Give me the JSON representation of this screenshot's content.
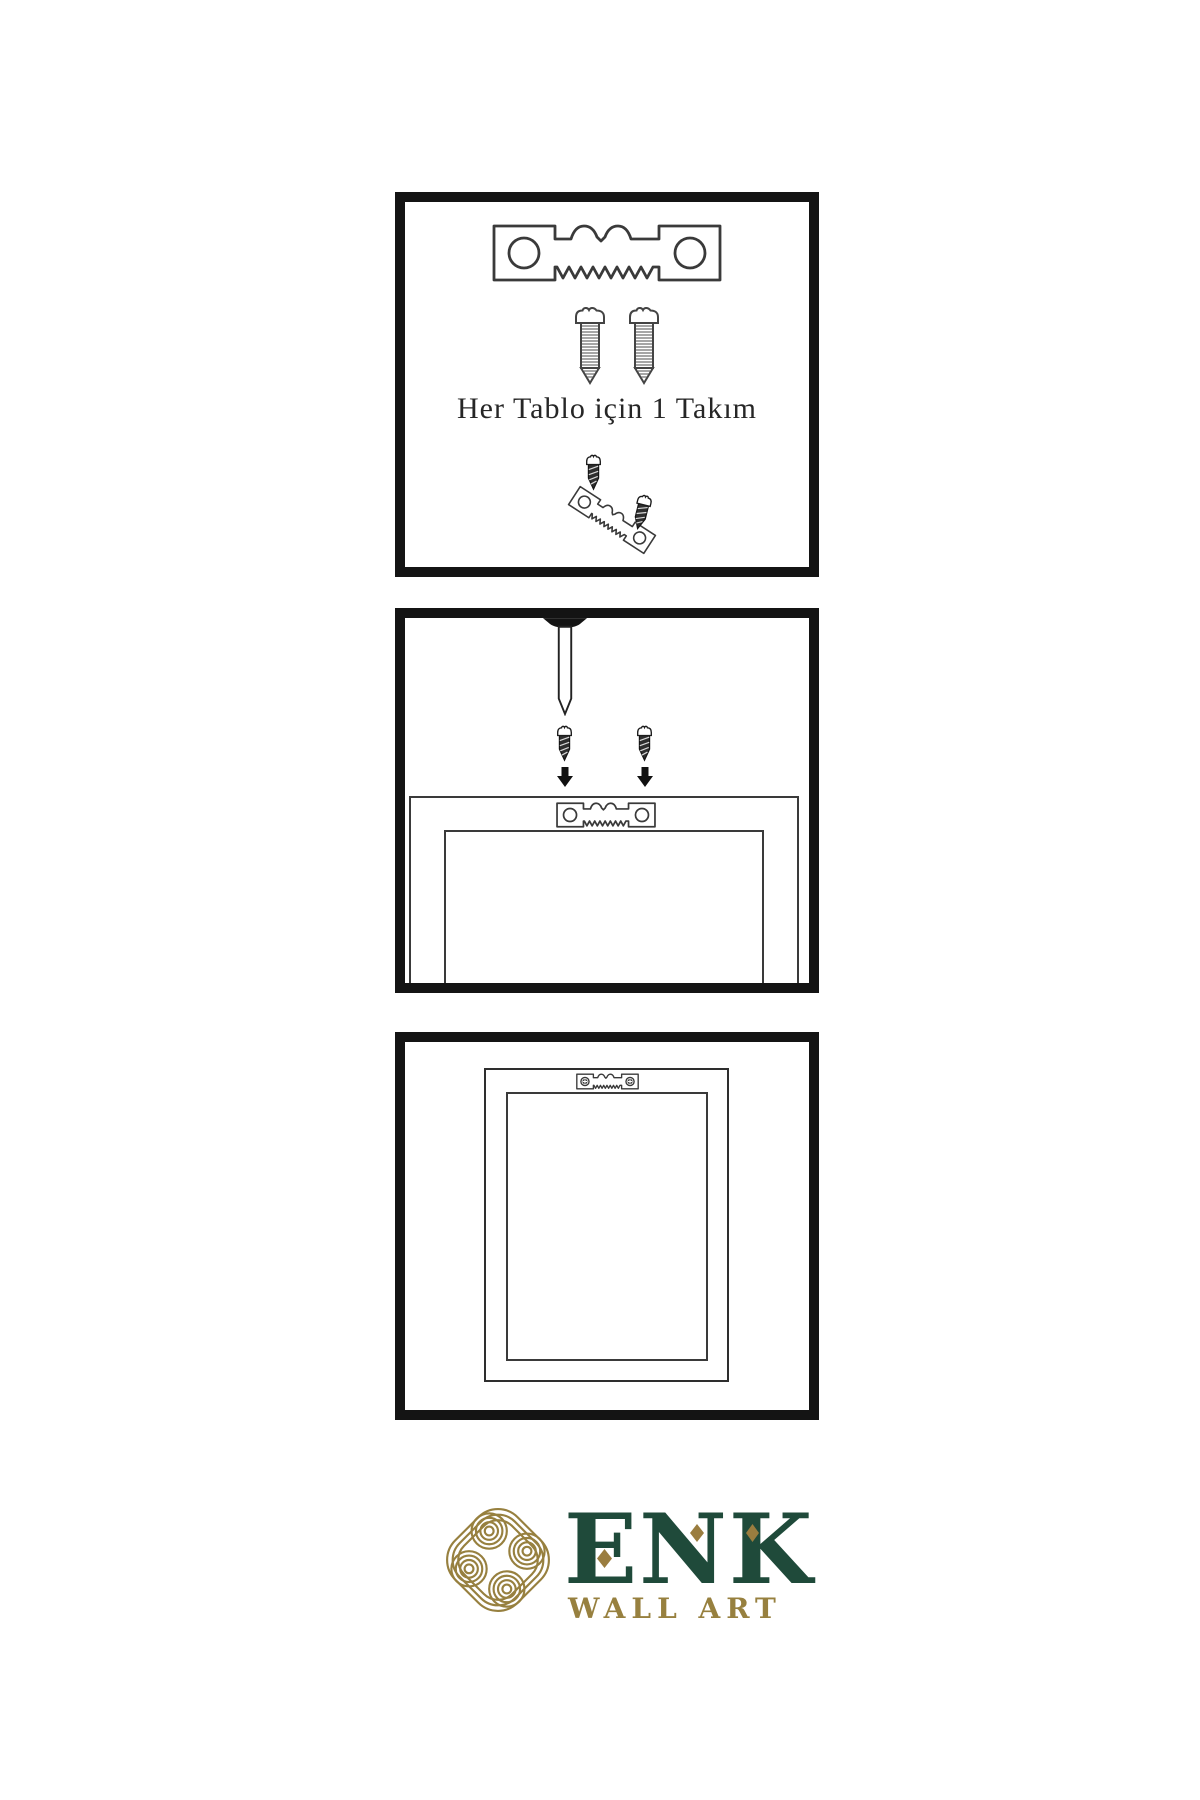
{
  "panels": {
    "kit": {
      "caption": "Her Tablo için 1 Takım",
      "icons": [
        "sawtooth-hanger-icon",
        "screw-icon",
        "screw-icon",
        "screw-into-hanger-icon"
      ]
    },
    "wall_mounting": {
      "icons": [
        "wall-nail-icon",
        "screw-icon",
        "arrow-down-icon",
        "frame-back-icon",
        "sawtooth-hanger-icon"
      ]
    },
    "hanging": {
      "icons": [
        "framed-picture-icon",
        "sawtooth-hanger-mounted-icon"
      ]
    }
  },
  "logo": {
    "brand": "ENK",
    "tagline": "WALL ART",
    "emblem": "knot-emblem-icon"
  },
  "colors": {
    "background": "#ffffff",
    "panel_border": "#141414",
    "line_art": "#3a3a3a",
    "dark_hardware": "#2e2e2e",
    "logo_green": "#1f4a3a",
    "logo_gold": "#97803f",
    "caption_text": "#262626"
  }
}
